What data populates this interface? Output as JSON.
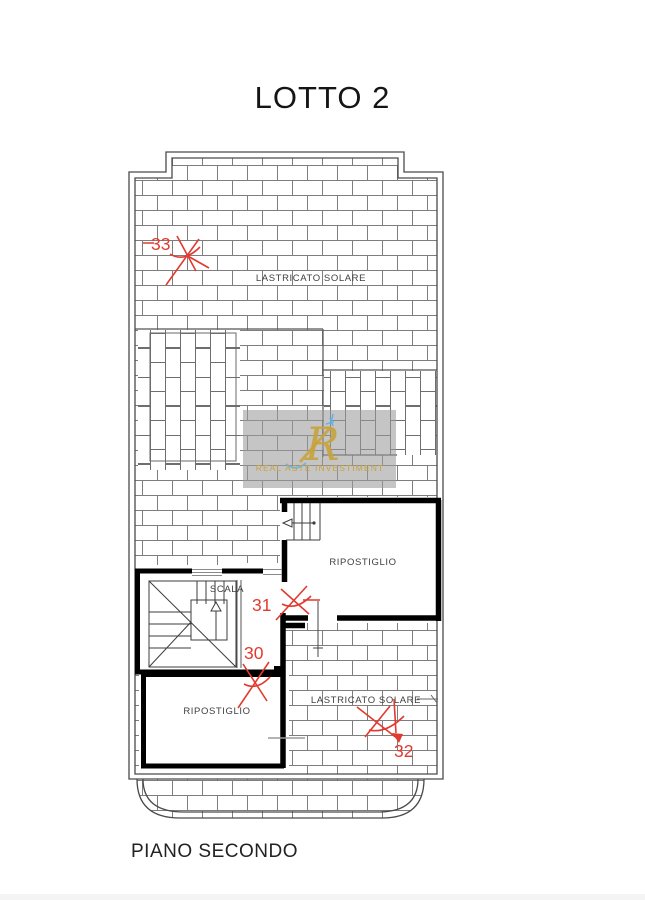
{
  "title": "LOTTO 2",
  "footer": "PIANO SECONDO",
  "plan": {
    "labels": {
      "lastricato_top": "LASTRICATO SOLARE",
      "lastricato_bottom": "LASTRICATO SOLARE",
      "ripostiglio_top": "RIPOSTIGLIO",
      "ripostiglio_bottom": "RIPOSTIGLIO",
      "scala": "SCALA"
    },
    "annotations": {
      "n33": "33",
      "n31": "31",
      "n30": "30",
      "n32": "32"
    },
    "colors": {
      "annotation_red": "#e13a2f",
      "mortar_gray": "#7e7e7e",
      "boundary_gray": "#555555",
      "wall_black": "#000000",
      "label_gray": "#3f3f3f"
    }
  },
  "watermark": {
    "logo_letter": "R",
    "caption": "REAL ASTE INVESTIMENT",
    "gold": "#c8a23c",
    "accent_blue": "#5fb0e8",
    "panel_gray": "#9b9b9b"
  }
}
